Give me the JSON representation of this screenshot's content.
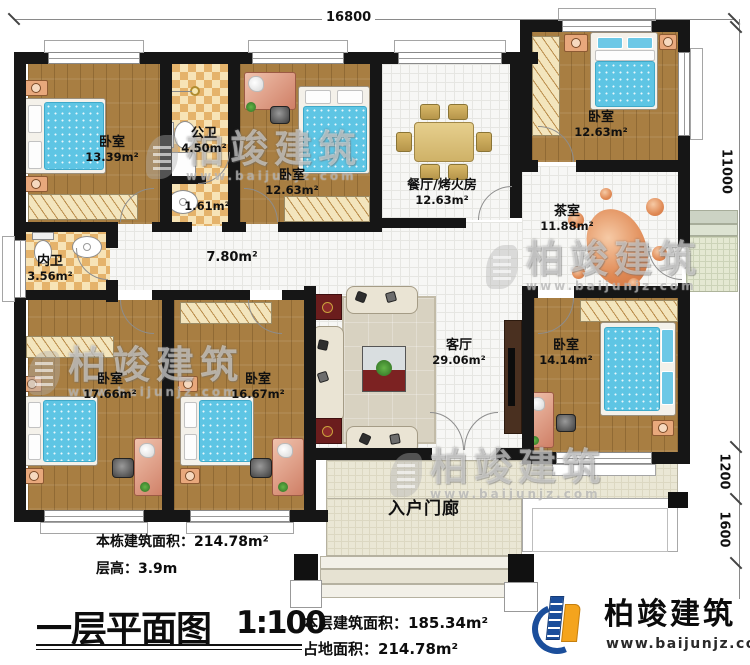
{
  "plan": {
    "title": "一层平面图",
    "scale": "1:100",
    "stats": {
      "building_total_label": "本栋建筑面积：",
      "building_total_value": "214.78m²",
      "floor_height_label": "层高：",
      "floor_height_value": "3.9m",
      "floor_area_label": "本层建筑面积：",
      "floor_area_value": "185.34m²",
      "footprint_label": "占地面积：",
      "footprint_value": "214.78m²"
    }
  },
  "dimensions": {
    "top": "16800",
    "right_main": "11000",
    "right_step": "1200",
    "right_porch": "1600"
  },
  "rooms": {
    "bedroom1": {
      "name": "卧室",
      "area": "13.39m²"
    },
    "bath_public": {
      "name": "公卫",
      "area": "4.50m²"
    },
    "bath_lobby": {
      "name": "",
      "area": "1.61m²"
    },
    "bedroom2": {
      "name": "卧室",
      "area": "12.63m²"
    },
    "dining": {
      "name": "餐厅/烤火房",
      "area": "12.63m²"
    },
    "bedroom3": {
      "name": "卧室",
      "area": "12.63m²"
    },
    "tea": {
      "name": "茶室",
      "area": "11.88m²"
    },
    "bath_inner": {
      "name": "内卫",
      "area": "3.56m²"
    },
    "corridor": {
      "name": "",
      "area": "7.80m²"
    },
    "bedroom4": {
      "name": "卧室",
      "area": "17.66m²"
    },
    "bedroom5": {
      "name": "卧室",
      "area": "16.67m²"
    },
    "living": {
      "name": "客厅",
      "area": "29.06m²"
    },
    "bedroom6": {
      "name": "卧室",
      "area": "14.14m²"
    },
    "porch": {
      "name": "入户门廊",
      "area": ""
    }
  },
  "branding": {
    "name": "柏竣建筑",
    "url": "www.baijunjz.com"
  },
  "watermark": {
    "name": "柏竣建筑",
    "url": "www.baijunjz.com"
  },
  "colors": {
    "wall": "#161616",
    "wood_floor": "#a87e42",
    "tile": "#f7f7f5",
    "checker_tile": "#e5b36b",
    "porch": "#eae7d5",
    "mattress": "#5ec5e4",
    "desk": "#dfa48e",
    "tea_rug": "#e08a55",
    "logo_blue": "#1b4e9b",
    "logo_orange": "#f4a41d"
  }
}
